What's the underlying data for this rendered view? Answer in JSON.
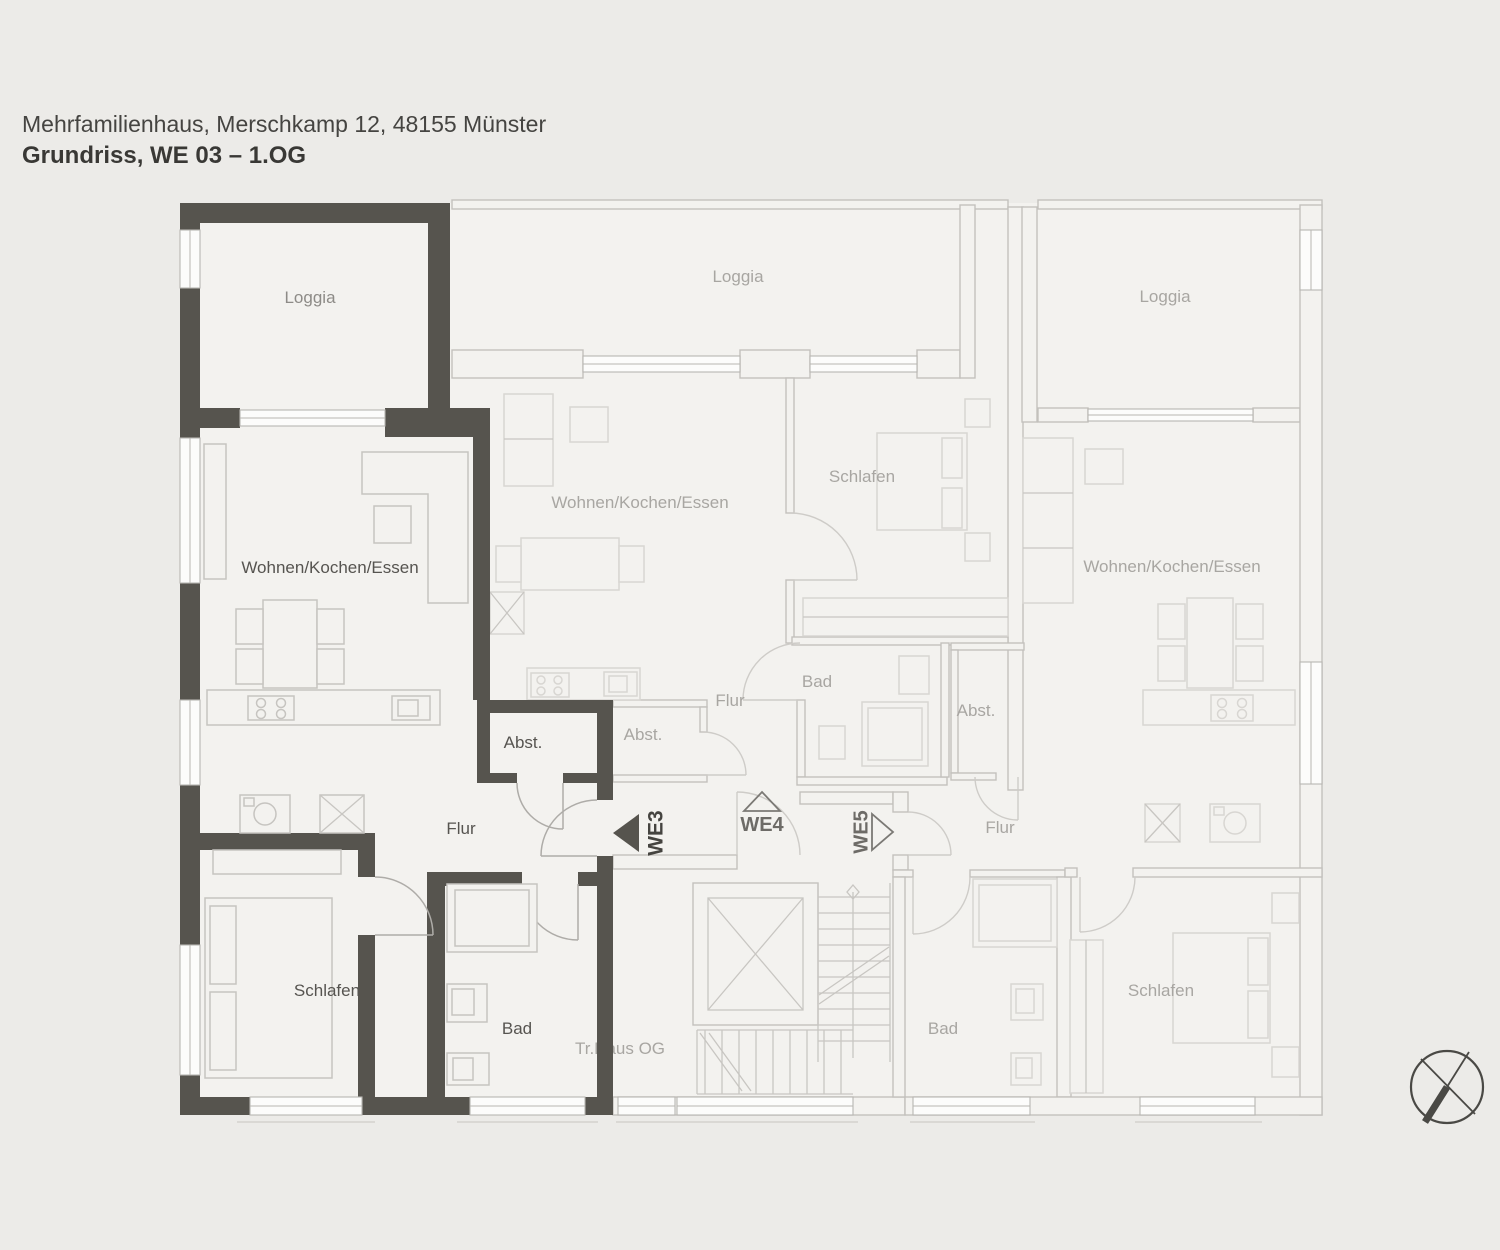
{
  "header": {
    "address": "Mehrfamilienhaus, Merschkamp 12, 48155 Münster",
    "title": "Grundriss, WE 03 – 1.OG"
  },
  "apartments": {
    "we3": {
      "marker": "WE3",
      "rooms": {
        "loggia": "Loggia",
        "living": "Wohnen/Kochen/Essen",
        "hall": "Flur",
        "storage": "Abst.",
        "bedroom": "Schlafen",
        "bath": "Bad"
      }
    },
    "we4": {
      "marker": "WE4",
      "rooms": {
        "loggia": "Loggia",
        "living": "Wohnen/Kochen/Essen",
        "bedroom": "Schlafen",
        "bath": "Bad",
        "hall": "Flur",
        "storage": "Abst."
      }
    },
    "we5": {
      "marker": "WE5",
      "rooms": {
        "loggia": "Loggia",
        "living": "Wohnen/Kochen/Essen",
        "bedroom": "Schlafen",
        "bath": "Bad",
        "hall": "Flur",
        "storage": "Abst."
      }
    }
  },
  "stairwell": {
    "label": "Tr.Haus OG"
  },
  "icons": {
    "compass": "compass-north-icon"
  },
  "colors": {
    "background": "#ecebe8",
    "room_fill": "#f3f2ef",
    "wall_dark": "#56544e",
    "wall_light": "#c3c1bd",
    "furniture_faded": "#d8d6d2",
    "label_faded": "#a8a6a2",
    "label_dark": "#565450",
    "title_text": "#393835"
  }
}
